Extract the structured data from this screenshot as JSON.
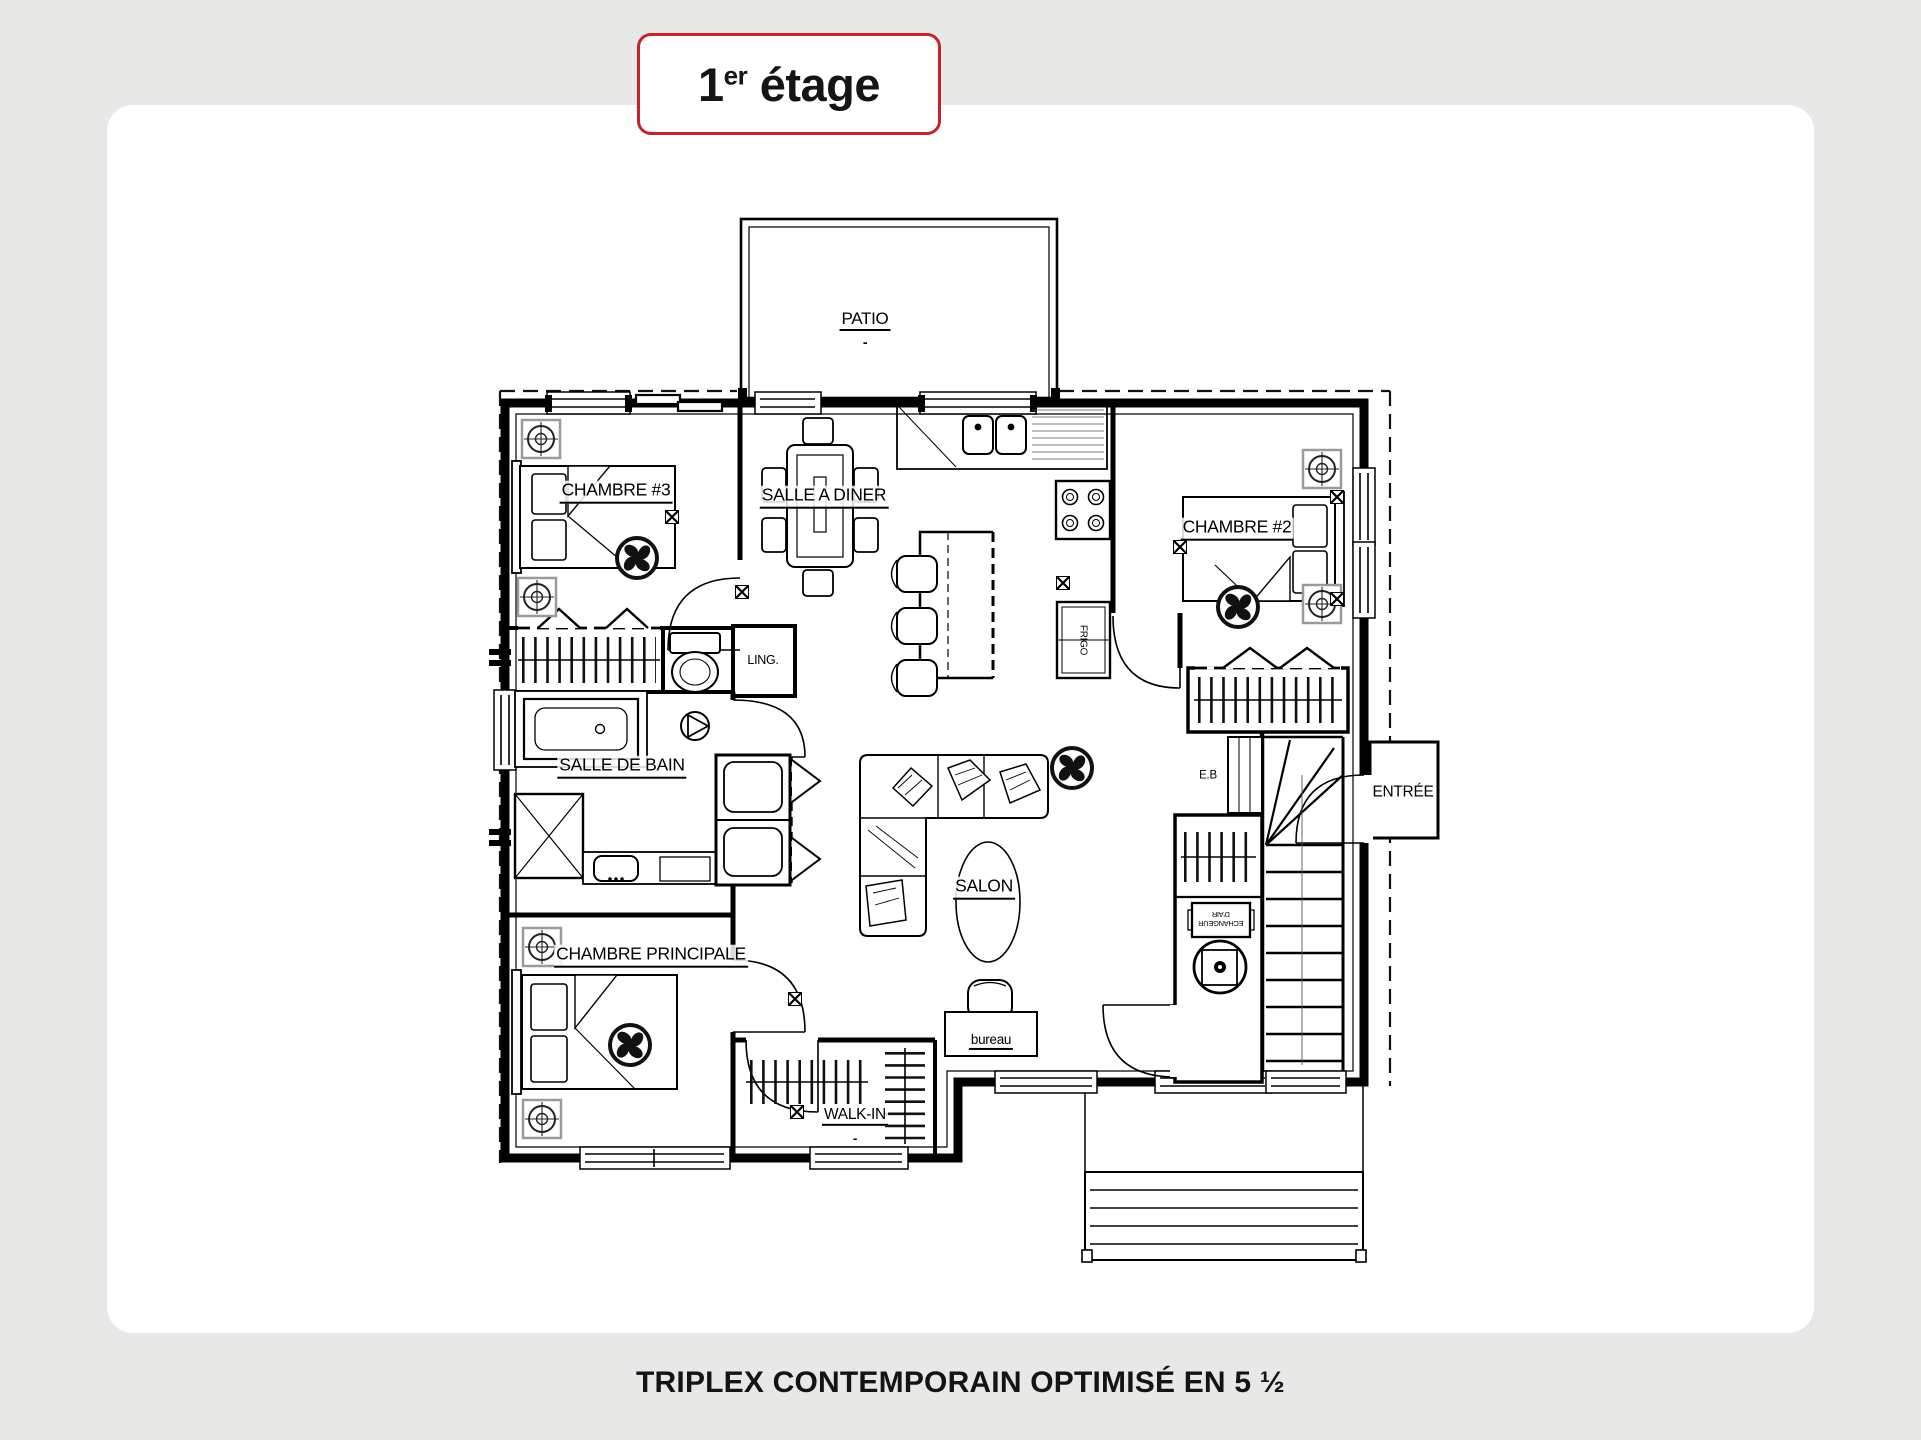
{
  "page": {
    "background": "#e8e8e7",
    "card_background": "#ffffff",
    "accent_red": "#c5232b",
    "line_color": "#000000"
  },
  "badge": {
    "number": "1",
    "ordinal": "er",
    "word": " étage"
  },
  "caption": "TRIPLEX CONTEMPORAIN OPTIMISÉ EN 5 ½",
  "plan": {
    "labels": {
      "patio": "PATIO",
      "chambre3": "CHAMBRE #3",
      "salle_a_diner": "SALLE A DINER",
      "chambre2": "CHAMBRE #2",
      "frigo": "FRIGO",
      "ling": "LING.",
      "salle_de_bain": "SALLE DE BAIN",
      "salon": "SALON",
      "eb": "E.B",
      "entree": "ENTRÉE",
      "chambre_principale": "CHAMBRE PRINCIPALE",
      "bureau": "bureau",
      "walkin": "WALK-IN",
      "echangeur_line1": "ECHANGEUR",
      "echangeur_line2": "D'AIR",
      "area_dash": "-"
    }
  }
}
